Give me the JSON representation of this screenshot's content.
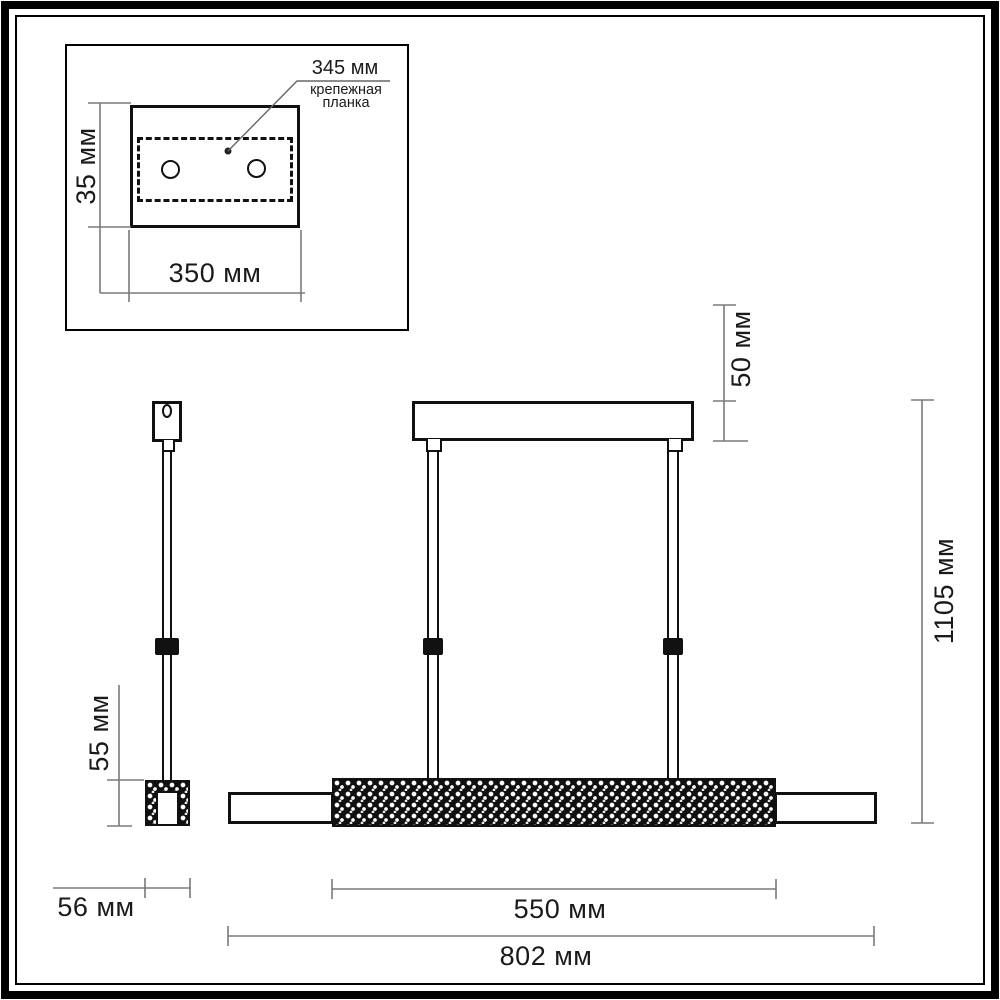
{
  "drawing": {
    "type": "technical dimension drawing",
    "subject": "linear pendant lamp with crystal diffuser",
    "colors": {
      "line": "#111111",
      "dimension_line": "#7a7a7a",
      "background": "#ffffff",
      "black_fill": "#101010"
    }
  },
  "labels": {
    "plate_span": "345 мм",
    "plate_caption_1": "крепежная",
    "plate_caption_2": "планка",
    "plate_height": "35 мм",
    "plate_width": "350 мм",
    "canopy_height": "50 мм",
    "overall_drop": "1105 мм",
    "cap_height": "55 мм",
    "cap_width": "56 мм",
    "crystal_length": "550 мм",
    "overall_length": "802 мм"
  }
}
